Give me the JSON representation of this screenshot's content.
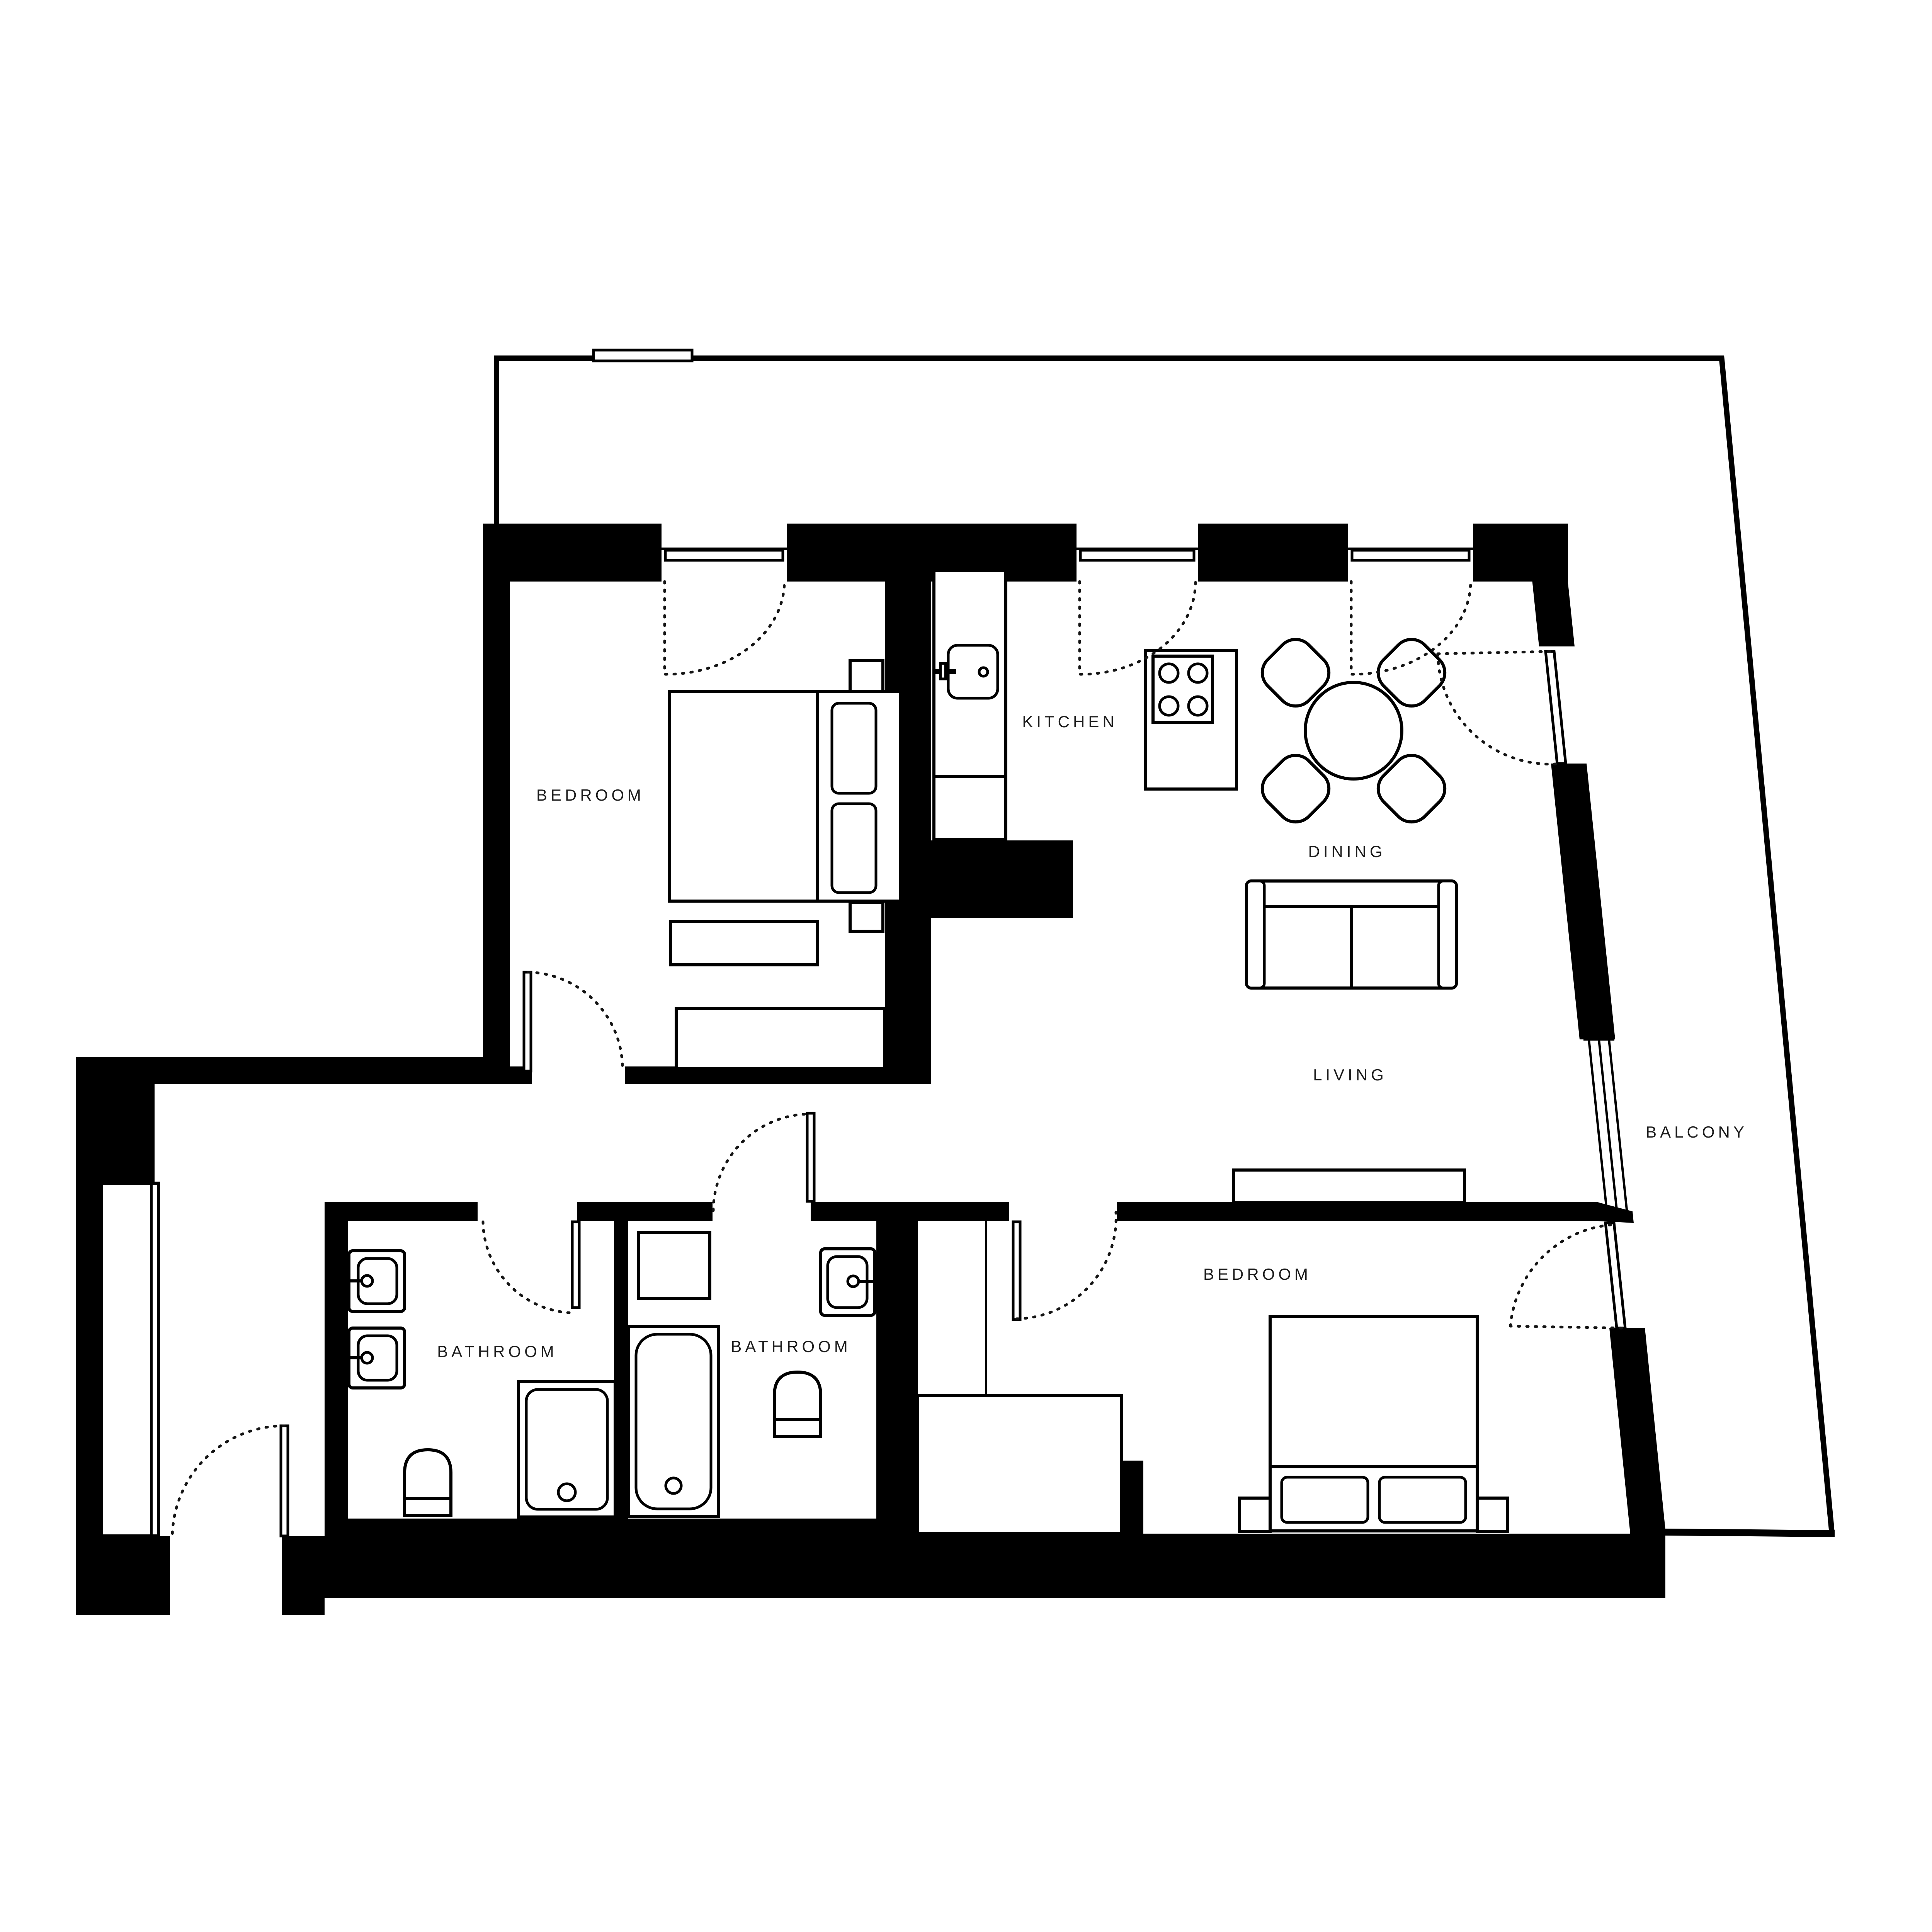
{
  "rooms": [
    {
      "id": "bedroom-1",
      "label": "BEDROOM"
    },
    {
      "id": "kitchen",
      "label": "KITCHEN"
    },
    {
      "id": "dining",
      "label": "DINING"
    },
    {
      "id": "living",
      "label": "LIVING"
    },
    {
      "id": "balcony",
      "label": "BALCONY"
    },
    {
      "id": "bathroom-1",
      "label": "BATHROOM"
    },
    {
      "id": "bathroom-2",
      "label": "BATHROOM"
    },
    {
      "id": "bedroom-2",
      "label": "BEDROOM"
    }
  ],
  "colors": {
    "walls": "#000000",
    "background": "#ffffff",
    "label_text": "#1c1c1c"
  },
  "furniture_icons": [
    "double-bed-icon",
    "pillow-icon",
    "nightstand-icon",
    "bench-icon",
    "kitchen-counter-icon",
    "kitchen-sink-icon",
    "stove-icon",
    "dining-table-icon",
    "dining-chair-icon",
    "sofa-icon",
    "tv-console-icon",
    "vanity-sink-icon",
    "toilet-icon",
    "shower-icon",
    "bathtub-icon",
    "washer-icon",
    "wardrobe-icon",
    "door-swing-icon",
    "window-icon"
  ]
}
